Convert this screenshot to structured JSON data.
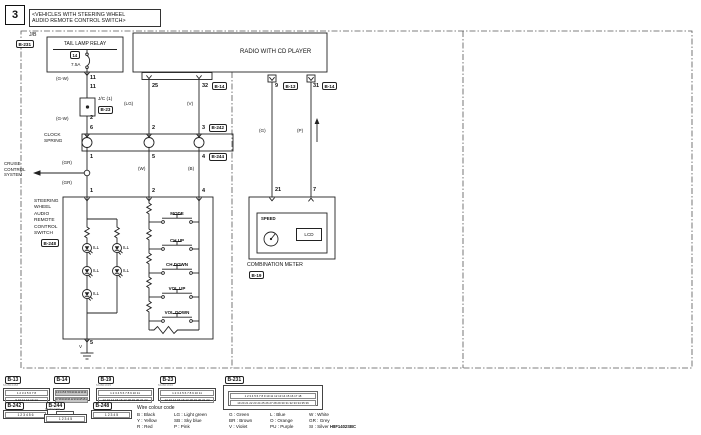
{
  "figure": {
    "number": "3",
    "title_line1": "<VEHICLES WITH STEERING WHEEL",
    "title_line2": "AUDIO REMOTE CONTROL SWITCH>"
  },
  "drawing_code": "H8F1402SBC",
  "tail_lamp_circuit": {
    "jb_label": "J/B",
    "jb_connector": "B-231",
    "relay": "TAIL LAMP RELAY",
    "fuse_number": "14",
    "fuse_rating": "7.5A",
    "pin_jb": "11",
    "pin_jc_in": "11",
    "wire_color_upper": "(G-W)",
    "wire_color_lower": "(G-W)",
    "jc_label": "J/C (1)",
    "jc_connector": "B-23",
    "pin_jc_out": "2"
  },
  "radio": {
    "label": "RADIO WITH CD PLAYER",
    "pin_25": "25",
    "pin_32": "32",
    "connector_b14": "B-14",
    "wire_lg": "(LG)",
    "wire_v": "(V)",
    "pin_9": "9",
    "connector_b13": "B-13",
    "pin_31": "31",
    "connector_b14_right": "B-14",
    "wire_g": "(G)",
    "wire_p": "(P)"
  },
  "clock_spring": {
    "label_1": "CLOCK",
    "label_2": "SPRING",
    "pin_top_left": "6",
    "pin_top_mid": "2",
    "pin_top_right": "3",
    "connector_top": "B-242",
    "pin_bot_left": "1",
    "pin_bot_mid": "5",
    "pin_bot_right": "4",
    "connector_bottom": "B-244"
  },
  "cruise": {
    "label_1": "CRUISE",
    "label_2": "CONTROL",
    "label_3": "SYSTEM",
    "wire_gr_upper": "(GR)",
    "wire_gr_lower": "(GR)"
  },
  "switch": {
    "name_1": "STEERING",
    "name_2": "WHEEL",
    "name_3": "AUDIO",
    "name_4": "REMOTE",
    "name_5": "CONTROL",
    "name_6": "SWITCH",
    "connector": "B-248",
    "pin_1": "1",
    "pin_2": "2",
    "pin_4": "4",
    "pin_5": "5",
    "wire_w": "(W)",
    "wire_b": "(B)",
    "ground_wire": "V",
    "ill": "ILL",
    "btn_mode": "MODE",
    "btn_ch_up": "CH UP",
    "btn_ch_down": "CH DOWN",
    "btn_vol_up": "VOL UP",
    "btn_vol_down": "VOL DOWN"
  },
  "meter": {
    "label": "COMBINATION METER",
    "connector": "B-19",
    "pin_21": "21",
    "pin_7": "7",
    "speed": "SPEED",
    "lcd": "LCD"
  },
  "connectors": {
    "b13": {
      "id": "B-13",
      "code": "MU804463",
      "row1": "1 2 3 4 5 6 7 8",
      "row2": "9 10 11 12 13 14"
    },
    "b14": {
      "id": "B-14",
      "row1": "1 2 3 4 5 6 7 8 9 10 11 12 13 14 15 16",
      "row2": "17 18 19 20 21 22 23 24 25 26 27 28 29 30 31 32"
    },
    "b19": {
      "id": "B-19",
      "code": "MU801915",
      "row1": "1 2 3 4 5 6 7 8 9 10 11",
      "row2": "12 13 14 15 16 17 18 19 20 21 22"
    },
    "b23": {
      "id": "B-23",
      "code": "MU801916",
      "row1": "1 2 3 4 5 6 7 8 9 10 11",
      "row2": "12 13 14 15 16 17 18 19 20 21 22"
    },
    "b231": {
      "id": "B-231",
      "row1": "1 2 3 4 5 6 7 8 9 10 11 12 13 14 15 16 17 18",
      "row2": "19 20 21 22 23 24 25 26 27 28 29 30 31 32 33 34 35 36"
    },
    "b242": {
      "id": "B-242",
      "row1": "1 2 3 4 5 6"
    },
    "b244": {
      "id": "B-244",
      "code": "MU804776",
      "row1": "1 2 3 4 5"
    },
    "b248": {
      "id": "B-248",
      "row1": "1 2 3 4 5"
    }
  },
  "legend": {
    "title": "Wire colour code",
    "entries": [
      "B : Black",
      "LG : Light green",
      "G : Green",
      "L : Blue",
      "W : White",
      "Y : Yellow",
      "SB : Sky blue",
      "BR : Brown",
      "O : Orange",
      "GR : Grey",
      "R : Red",
      "P : Pink",
      "V : Violet",
      "PU : Purple",
      "SI : Silver"
    ]
  }
}
